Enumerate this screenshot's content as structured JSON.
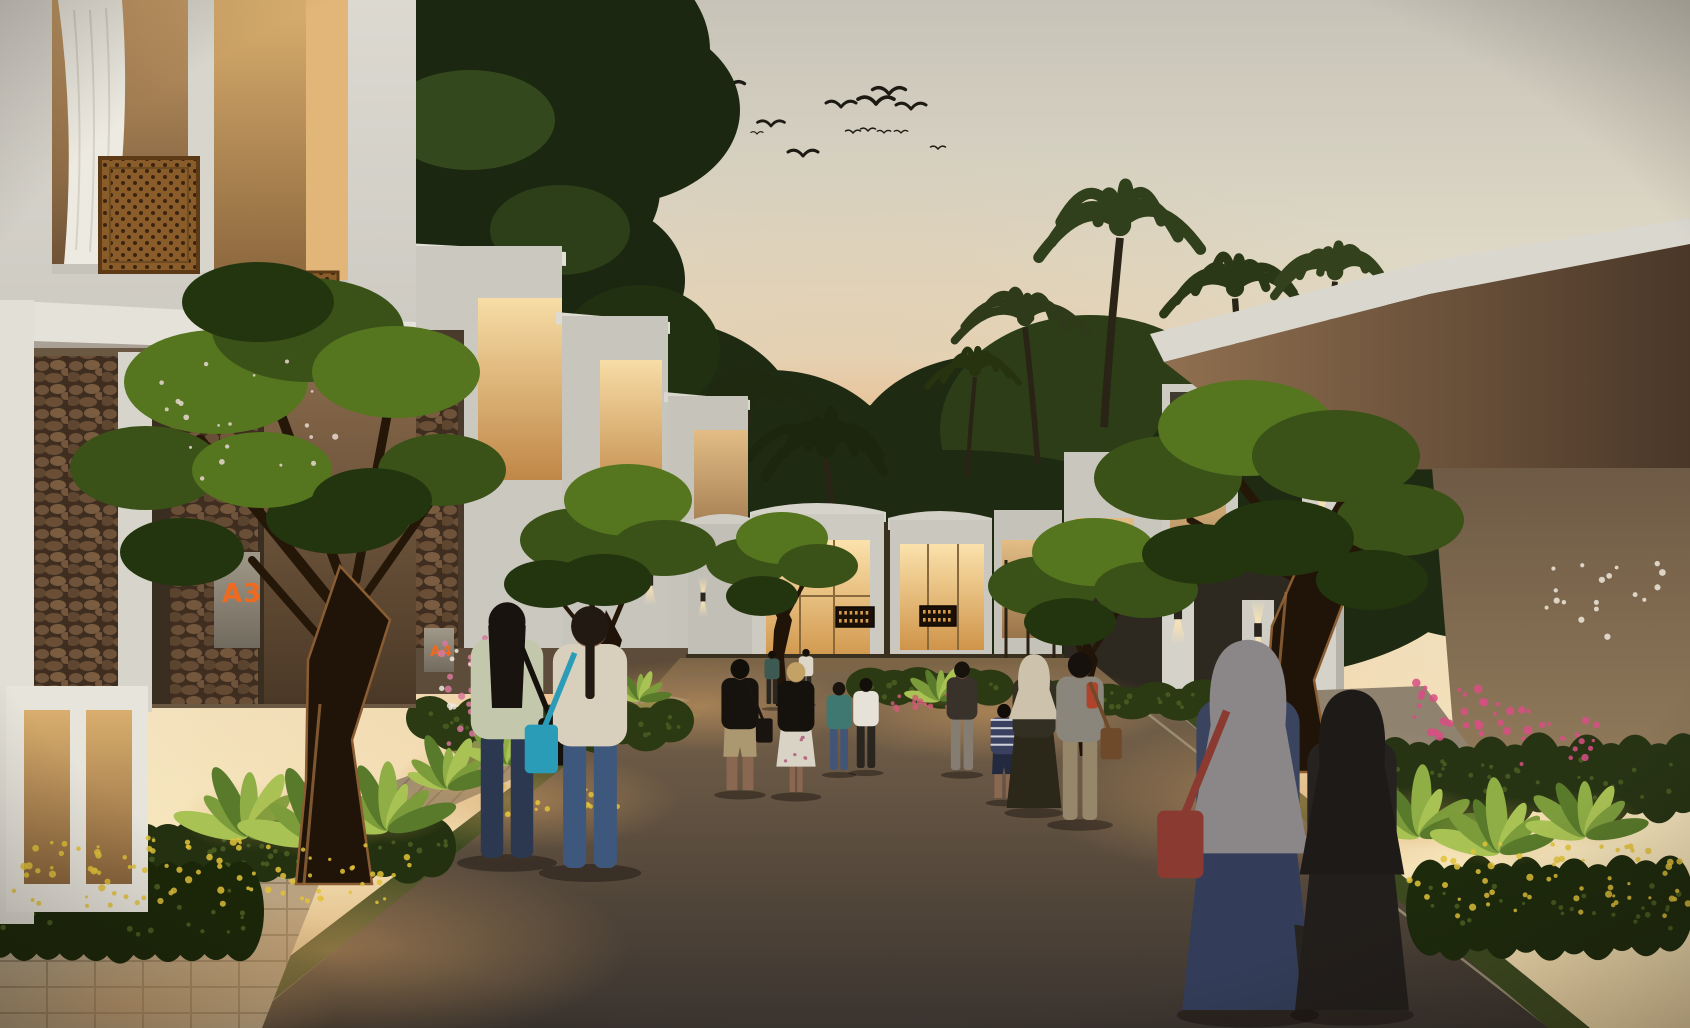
{
  "scene": {
    "description": "Photorealistic dusk rendering of a modern tropical townhouse cluster street with walking residents, frangipani trees, palm silhouettes and warm architectural lighting",
    "time_of_day": "sunset"
  },
  "signs": [
    {
      "label": "A3"
    },
    {
      "label": "A4"
    }
  ],
  "palette": {
    "sign_text": "#ef6a1e",
    "sky_top": "#c7c3b8",
    "sky_mid": "#f0e7cc",
    "sky_low": "#f2d9a8",
    "glow": "#f2b26a",
    "bird": "#1d1a14",
    "building_light": "#dcd9d1",
    "building_mid": "#cbc8c0",
    "window_hi": "#f7dda6",
    "window_lo": "#c08747",
    "road_far": "#7c664d",
    "road_near": "#3a342f",
    "grass": "#3d4a20",
    "flower_yellow": "#e2c23a",
    "flower_pink": "#d84f82",
    "skin": "#8a6750",
    "cluster_greens": [
      "#23350f",
      "#3a5218",
      "#55751f"
    ],
    "bg_greens": [
      "#1e2a11",
      "#2c3d17",
      "#3e5522"
    ],
    "banana_greens": [
      "#a9c254",
      "#7c9c3c",
      "#597a2a",
      "#8fae46"
    ]
  },
  "birds": [
    {
      "x": 728,
      "y": 88,
      "s": 1.1
    },
    {
      "x": 771,
      "y": 126,
      "s": 0.9
    },
    {
      "x": 803,
      "y": 156,
      "s": 1.0
    },
    {
      "x": 841,
      "y": 107,
      "s": 1.0
    },
    {
      "x": 876,
      "y": 104,
      "s": 1.2
    },
    {
      "x": 889,
      "y": 94,
      "s": 1.1
    },
    {
      "x": 911,
      "y": 109,
      "s": 1.0
    },
    {
      "x": 853,
      "y": 133,
      "s": 0.5
    },
    {
      "x": 868,
      "y": 131,
      "s": 0.5
    },
    {
      "x": 884,
      "y": 133,
      "s": 0.45
    },
    {
      "x": 901,
      "y": 133,
      "s": 0.45
    },
    {
      "x": 938,
      "y": 149,
      "s": 0.5
    },
    {
      "x": 757,
      "y": 134,
      "s": 0.4
    }
  ],
  "bg_trees": [
    {
      "x": 560,
      "y": 470,
      "rx": 120,
      "ry": 95,
      "c": 0
    },
    {
      "x": 660,
      "y": 430,
      "rx": 140,
      "ry": 110,
      "c": 0
    },
    {
      "x": 770,
      "y": 470,
      "rx": 130,
      "ry": 100,
      "c": 0
    },
    {
      "x": 880,
      "y": 500,
      "rx": 150,
      "ry": 95,
      "c": 0
    },
    {
      "x": 990,
      "y": 460,
      "rx": 140,
      "ry": 105,
      "c": 0
    },
    {
      "x": 1090,
      "y": 430,
      "rx": 150,
      "ry": 115,
      "c": 1
    },
    {
      "x": 1200,
      "y": 460,
      "rx": 160,
      "ry": 115,
      "c": 1
    },
    {
      "x": 1300,
      "y": 480,
      "rx": 160,
      "ry": 110,
      "c": 0
    },
    {
      "x": 1400,
      "y": 505,
      "rx": 150,
      "ry": 100,
      "c": 1
    },
    {
      "x": 700,
      "y": 540,
      "rx": 220,
      "ry": 110,
      "c": 0
    },
    {
      "x": 950,
      "y": 560,
      "rx": 260,
      "ry": 110,
      "c": 0
    },
    {
      "x": 1230,
      "y": 570,
      "rx": 240,
      "ry": 110,
      "c": 0
    },
    {
      "x": 480,
      "y": 520,
      "rx": 120,
      "ry": 90,
      "c": 0
    },
    {
      "x": 1490,
      "y": 540,
      "rx": 160,
      "ry": 100,
      "c": 0
    }
  ],
  "canopies": [
    {
      "x": 250,
      "y": 30,
      "rx": 190,
      "ry": 120,
      "c": "#1b2710"
    },
    {
      "x": 400,
      "y": 80,
      "rx": 210,
      "ry": 150,
      "c": "#1b2710"
    },
    {
      "x": 540,
      "y": 50,
      "rx": 170,
      "ry": 120,
      "c": "#1b2710"
    },
    {
      "x": 330,
      "y": 180,
      "rx": 190,
      "ry": 115,
      "c": "#1b2710"
    },
    {
      "x": 500,
      "y": 190,
      "rx": 160,
      "ry": 105,
      "c": "#1b2710"
    },
    {
      "x": 610,
      "y": 110,
      "rx": 130,
      "ry": 95,
      "c": "#1b2710"
    },
    {
      "x": 585,
      "y": 280,
      "rx": 100,
      "ry": 80,
      "c": "#1b2710"
    },
    {
      "x": 640,
      "y": 350,
      "rx": 80,
      "ry": 65,
      "c": "#223012"
    },
    {
      "x": 300,
      "y": 90,
      "rx": 90,
      "ry": 55,
      "c": "#33491d"
    },
    {
      "x": 470,
      "y": 120,
      "rx": 85,
      "ry": 50,
      "c": "#33491d"
    },
    {
      "x": 560,
      "y": 230,
      "rx": 70,
      "ry": 45,
      "c": "#2c3f18"
    },
    {
      "x": 1560,
      "y": 430,
      "rx": 95,
      "ry": 55,
      "c": "#3a5220"
    },
    {
      "x": 1645,
      "y": 480,
      "rx": 100,
      "ry": 60,
      "c": "#2f4418"
    },
    {
      "x": 1605,
      "y": 560,
      "rx": 85,
      "ry": 50,
      "c": "#496628"
    },
    {
      "x": 1680,
      "y": 615,
      "rx": 80,
      "ry": 50,
      "c": "#2f4418"
    },
    {
      "x": 1530,
      "y": 505,
      "rx": 70,
      "ry": 45,
      "c": "#263812"
    },
    {
      "x": 1665,
      "y": 700,
      "rx": 70,
      "ry": 45,
      "c": "#1f2d0e"
    }
  ],
  "palms": [
    {
      "x": 748,
      "y": 402,
      "r": 66,
      "c": "#1f2910",
      "lean": -8
    },
    {
      "x": 826,
      "y": 448,
      "r": 74,
      "c": "#1c250e",
      "lean": 10
    },
    {
      "x": 700,
      "y": 452,
      "r": 40,
      "c": "#232c12",
      "lean": -6
    },
    {
      "x": 655,
      "y": 448,
      "r": 42,
      "c": "#2c3a18",
      "lean": 5
    },
    {
      "x": 1025,
      "y": 318,
      "r": 62,
      "c": "#2e3a1a",
      "lean": 8
    },
    {
      "x": 1120,
      "y": 225,
      "r": 86,
      "c": "#31401c",
      "lean": -10
    },
    {
      "x": 1235,
      "y": 288,
      "r": 70,
      "c": "#2b3817",
      "lean": 6
    },
    {
      "x": 1335,
      "y": 272,
      "r": 64,
      "c": "#33421d",
      "lean": -8
    },
    {
      "x": 1435,
      "y": 300,
      "r": 60,
      "c": "#2b3817",
      "lean": 8
    },
    {
      "x": 1545,
      "y": 335,
      "r": 52,
      "c": "#2e3a1a",
      "lean": -6
    },
    {
      "x": 975,
      "y": 370,
      "r": 46,
      "c": "#27330f",
      "lean": -5
    }
  ],
  "frangipani": [
    {
      "trunk": "596,766 612,766 608,690 622,640 606,610 596,652 594,716",
      "branches": [
        [
          604,
          640,
          576,
          560,
          5
        ],
        [
          608,
          636,
          640,
          560,
          5
        ],
        [
          600,
          650,
          560,
          600,
          4
        ]
      ],
      "clusters": [
        [
          578,
          540,
          58,
          32,
          1
        ],
        [
          628,
          500,
          64,
          36,
          2
        ],
        [
          664,
          548,
          52,
          28,
          1
        ],
        [
          604,
          580,
          48,
          26,
          0
        ],
        [
          548,
          584,
          44,
          24,
          0
        ]
      ]
    },
    {
      "trunk": "776,706 788,706 784,656 792,620 782,600 774,630 772,668",
      "branches": [
        [
          782,
          622,
          756,
          576,
          4
        ],
        [
          784,
          620,
          810,
          572,
          4
        ]
      ],
      "clusters": [
        [
          748,
          562,
          42,
          24,
          1
        ],
        [
          782,
          538,
          46,
          26,
          2
        ],
        [
          818,
          566,
          40,
          22,
          1
        ],
        [
          762,
          596,
          36,
          20,
          0
        ]
      ]
    },
    {
      "trunk": "1080,756 1094,756 1088,700 1098,660 1086,636 1076,668 1076,716",
      "branches": [
        [
          1086,
          660,
          1054,
          600,
          5
        ],
        [
          1090,
          656,
          1128,
          596,
          5
        ]
      ],
      "clusters": [
        [
          1044,
          586,
          56,
          30,
          1
        ],
        [
          1094,
          552,
          62,
          34,
          2
        ],
        [
          1146,
          590,
          52,
          28,
          1
        ],
        [
          1070,
          622,
          46,
          24,
          0
        ]
      ]
    },
    {
      "trunk": "1262,772 1330,772 1314,680 1348,590 1306,548 1272,626 1266,706",
      "lit": true,
      "branches": [
        [
          1300,
          560,
          1230,
          470,
          9
        ],
        [
          1310,
          556,
          1360,
          470,
          8
        ],
        [
          1296,
          580,
          1190,
          520,
          7
        ],
        [
          1316,
          570,
          1408,
          520,
          7
        ]
      ],
      "clusters": [
        [
          1168,
          478,
          74,
          42,
          1
        ],
        [
          1246,
          428,
          88,
          48,
          2
        ],
        [
          1336,
          456,
          84,
          46,
          1
        ],
        [
          1400,
          520,
          64,
          36,
          1
        ],
        [
          1282,
          538,
          72,
          38,
          0
        ],
        [
          1200,
          554,
          58,
          30,
          0
        ],
        [
          1372,
          580,
          56,
          30,
          0
        ]
      ]
    },
    {
      "trunk": "296,884 372,884 352,740 390,620 340,566 308,660 306,780",
      "lit": true,
      "branches": [
        [
          330,
          600,
          200,
          440,
          11
        ],
        [
          344,
          586,
          268,
          380,
          10
        ],
        [
          356,
          580,
          390,
          400,
          9
        ],
        [
          362,
          600,
          446,
          480,
          8
        ],
        [
          322,
          640,
          252,
          560,
          8
        ]
      ],
      "clusters": [
        [
          146,
          468,
          76,
          42,
          1
        ],
        [
          216,
          382,
          92,
          52,
          2
        ],
        [
          308,
          330,
          96,
          52,
          1
        ],
        [
          396,
          372,
          84,
          46,
          2
        ],
        [
          442,
          470,
          64,
          36,
          1
        ],
        [
          258,
          302,
          76,
          40,
          0
        ],
        [
          182,
          552,
          62,
          34,
          0
        ],
        [
          338,
          518,
          72,
          36,
          0
        ],
        [
          262,
          470,
          70,
          38,
          2
        ],
        [
          372,
          500,
          60,
          32,
          0
        ]
      ]
    }
  ],
  "hedges": [
    {
      "x1": 0,
      "x2": 450,
      "y": 852,
      "ry": 30,
      "c": "#243110"
    },
    {
      "x1": 0,
      "x2": 260,
      "y": 910,
      "ry": 50,
      "c": "#1b2709"
    },
    {
      "x1": 430,
      "x2": 680,
      "y": 724,
      "ry": 22,
      "c": "#2b3a12"
    },
    {
      "x1": 870,
      "x2": 1000,
      "y": 688,
      "ry": 18,
      "c": "#2b3a12"
    },
    {
      "x1": 1060,
      "x2": 1240,
      "y": 700,
      "ry": 16,
      "c": "#2b3a12"
    },
    {
      "x1": 1395,
      "x2": 1690,
      "y": 780,
      "ry": 40,
      "c": "#273414"
    },
    {
      "x1": 1430,
      "x2": 1690,
      "y": 908,
      "ry": 48,
      "c": "#1d2a0c"
    }
  ],
  "banana_plants": [
    {
      "x": 248,
      "y": 836,
      "s": 1.1
    },
    {
      "x": 318,
      "y": 842,
      "s": 1.2
    },
    {
      "x": 388,
      "y": 830,
      "s": 1.0
    },
    {
      "x": 448,
      "y": 788,
      "s": 0.8
    },
    {
      "x": 508,
      "y": 764,
      "s": 0.65
    },
    {
      "x": 1420,
      "y": 836,
      "s": 1.0
    },
    {
      "x": 1500,
      "y": 852,
      "s": 1.1
    },
    {
      "x": 1586,
      "y": 836,
      "s": 0.9
    },
    {
      "x": 940,
      "y": 700,
      "s": 0.5
    },
    {
      "x": 640,
      "y": 700,
      "s": 0.45
    }
  ],
  "flower_patches": [
    {
      "x": 210,
      "y": 872,
      "rx": 200,
      "ry": 34,
      "n": 90,
      "c": "#e2c23a",
      "r": 2.6
    },
    {
      "x": 1548,
      "y": 880,
      "rx": 140,
      "ry": 36,
      "n": 60,
      "c": "#e2c23a",
      "r": 2.6
    },
    {
      "x": 560,
      "y": 800,
      "rx": 60,
      "ry": 16,
      "n": 22,
      "c": "#dfbf3a",
      "r": 2.2
    },
    {
      "x": 476,
      "y": 690,
      "rx": 36,
      "ry": 56,
      "n": 26,
      "c": "#d8789c",
      "r": 3
    },
    {
      "x": 470,
      "y": 672,
      "rx": 30,
      "ry": 40,
      "n": 12,
      "c": "#efe9dd",
      "r": 2.4
    },
    {
      "x": 1472,
      "y": 712,
      "rx": 60,
      "ry": 30,
      "n": 30,
      "c": "#d84f82",
      "r": 3.2
    },
    {
      "x": 1560,
      "y": 742,
      "rx": 40,
      "ry": 22,
      "n": 14,
      "c": "#d84f82",
      "r": 2.8
    },
    {
      "x": 1612,
      "y": 600,
      "rx": 70,
      "ry": 45,
      "n": 18,
      "c": "#eee8da",
      "r": 2.6
    },
    {
      "x": 920,
      "y": 700,
      "rx": 40,
      "ry": 12,
      "n": 16,
      "c": "#cf5b74",
      "r": 2.4
    },
    {
      "x": 250,
      "y": 420,
      "rx": 90,
      "ry": 60,
      "n": 20,
      "c": "#e8d7d2",
      "r": 2.2
    }
  ],
  "signage_panels": [
    {
      "x": 836,
      "y": 607,
      "w": 38,
      "h": 20
    },
    {
      "x": 920,
      "y": 606,
      "w": 36,
      "h": 20
    }
  ],
  "sconces": [
    {
      "x": 390,
      "y": 540,
      "s": 1.0
    },
    {
      "x": 577,
      "y": 560,
      "s": 0.8
    },
    {
      "x": 650,
      "y": 580,
      "s": 0.7
    },
    {
      "x": 703,
      "y": 597,
      "s": 0.55
    },
    {
      "x": 1178,
      "y": 612,
      "s": 0.9
    },
    {
      "x": 1258,
      "y": 630,
      "s": 0.85
    },
    {
      "x": 1322,
      "y": 516,
      "s": 1.0
    }
  ],
  "light_pools": [
    {
      "x": 330,
      "y": 950,
      "rx": 300,
      "ry": 100
    },
    {
      "x": 120,
      "y": 1008,
      "rx": 220,
      "ry": 70
    },
    {
      "x": 700,
      "y": 706,
      "rx": 160,
      "ry": 46
    },
    {
      "x": 990,
      "y": 712,
      "rx": 180,
      "ry": 50
    },
    {
      "x": 1282,
      "y": 800,
      "rx": 240,
      "ry": 80
    },
    {
      "x": 520,
      "y": 800,
      "rx": 160,
      "ry": 50
    }
  ],
  "people": [
    {
      "name": "distant-walker-teal",
      "x": 772,
      "y": 704,
      "h": 52,
      "hair": "#151009",
      "top": "#3c5a52",
      "bottom": "#2a2621"
    },
    {
      "name": "distant-walker-white",
      "x": 806,
      "y": 700,
      "h": 50,
      "hair": "#151009",
      "top": "#dcd7c9",
      "bottom": "#2c2823"
    },
    {
      "name": "woman-teal-top",
      "x": 839,
      "y": 770,
      "h": 86,
      "hair": "#1b130d",
      "top": "#3e7870",
      "bottom": "#415677"
    },
    {
      "name": "man-white-shirt",
      "x": 866,
      "y": 768,
      "h": 88,
      "hair": "#120e0a",
      "top": "#e6e2d7",
      "bottom": "#29251f"
    },
    {
      "name": "woman-dark-outfit",
      "x": 962,
      "y": 770,
      "h": 106,
      "hair": "#17120c",
      "top": "#39322a",
      "bottom": "#857d72"
    },
    {
      "name": "boy-striped-shirt",
      "x": 1004,
      "y": 798,
      "h": 92,
      "hair": "#120d08",
      "top": "#3a4160",
      "stripes": true,
      "bottom": "#232a40",
      "shorts": true
    },
    {
      "name": "man-black-polo",
      "x": 740,
      "y": 790,
      "h": 128,
      "hair": "#120e0a",
      "top": "#16120e",
      "bottom": "#ab9871",
      "shorts": true,
      "bag": {
        "side": 1,
        "color": "#191410"
      }
    },
    {
      "name": "blonde-woman-floral-skirt",
      "x": 796,
      "y": 792,
      "h": 127,
      "hair": "#c3a266",
      "top": "#15110d",
      "skirt": true,
      "floral": true,
      "bottom": "#d9d3c5"
    },
    {
      "name": "woman-beige-hijab",
      "x": 1034,
      "y": 808,
      "h": 148,
      "hijab": "#cdc2ab",
      "dress": true,
      "top": "#332f23",
      "bottom": "#2b2719"
    },
    {
      "name": "man-gray-tee-satchel",
      "x": 1080,
      "y": 820,
      "h": 164,
      "hair": "#16110c",
      "top": "#8b867c",
      "bottom": "#97876a",
      "accent": "#b0432c",
      "bag": {
        "side": 1,
        "color": "#6e4a2a"
      }
    },
    {
      "name": "woman-green-tee",
      "x": 507,
      "y": 858,
      "h": 250,
      "hair": "#191310",
      "longHair": true,
      "top": "#c3c8ad",
      "bottom": "#2c3750",
      "bag": {
        "side": 1,
        "color": "#15110d"
      }
    },
    {
      "name": "woman-teal-duffel",
      "x": 590,
      "y": 868,
      "h": 256,
      "hair": "#221a12",
      "ponytail": true,
      "top": "#d8d0bd",
      "bottom": "#3d587c",
      "bag": {
        "side": -1,
        "color": "#2a9cb8"
      }
    },
    {
      "name": "woman-gray-hijab-navy-dress",
      "x": 1248,
      "y": 1010,
      "h": 356,
      "hijab": "#8b8789",
      "hijabLong": true,
      "dress": true,
      "top": "#3a445f",
      "bottom": "#333d59",
      "bag": {
        "side": -1,
        "color": "#8a3a30"
      },
      "visor": true
    },
    {
      "name": "woman-black-hijab",
      "x": 1352,
      "y": 1010,
      "h": 308,
      "hijab": "#1e1a17",
      "hijabLong": true,
      "dress": true,
      "top": "#262220",
      "bottom": "#221e1b"
    }
  ]
}
